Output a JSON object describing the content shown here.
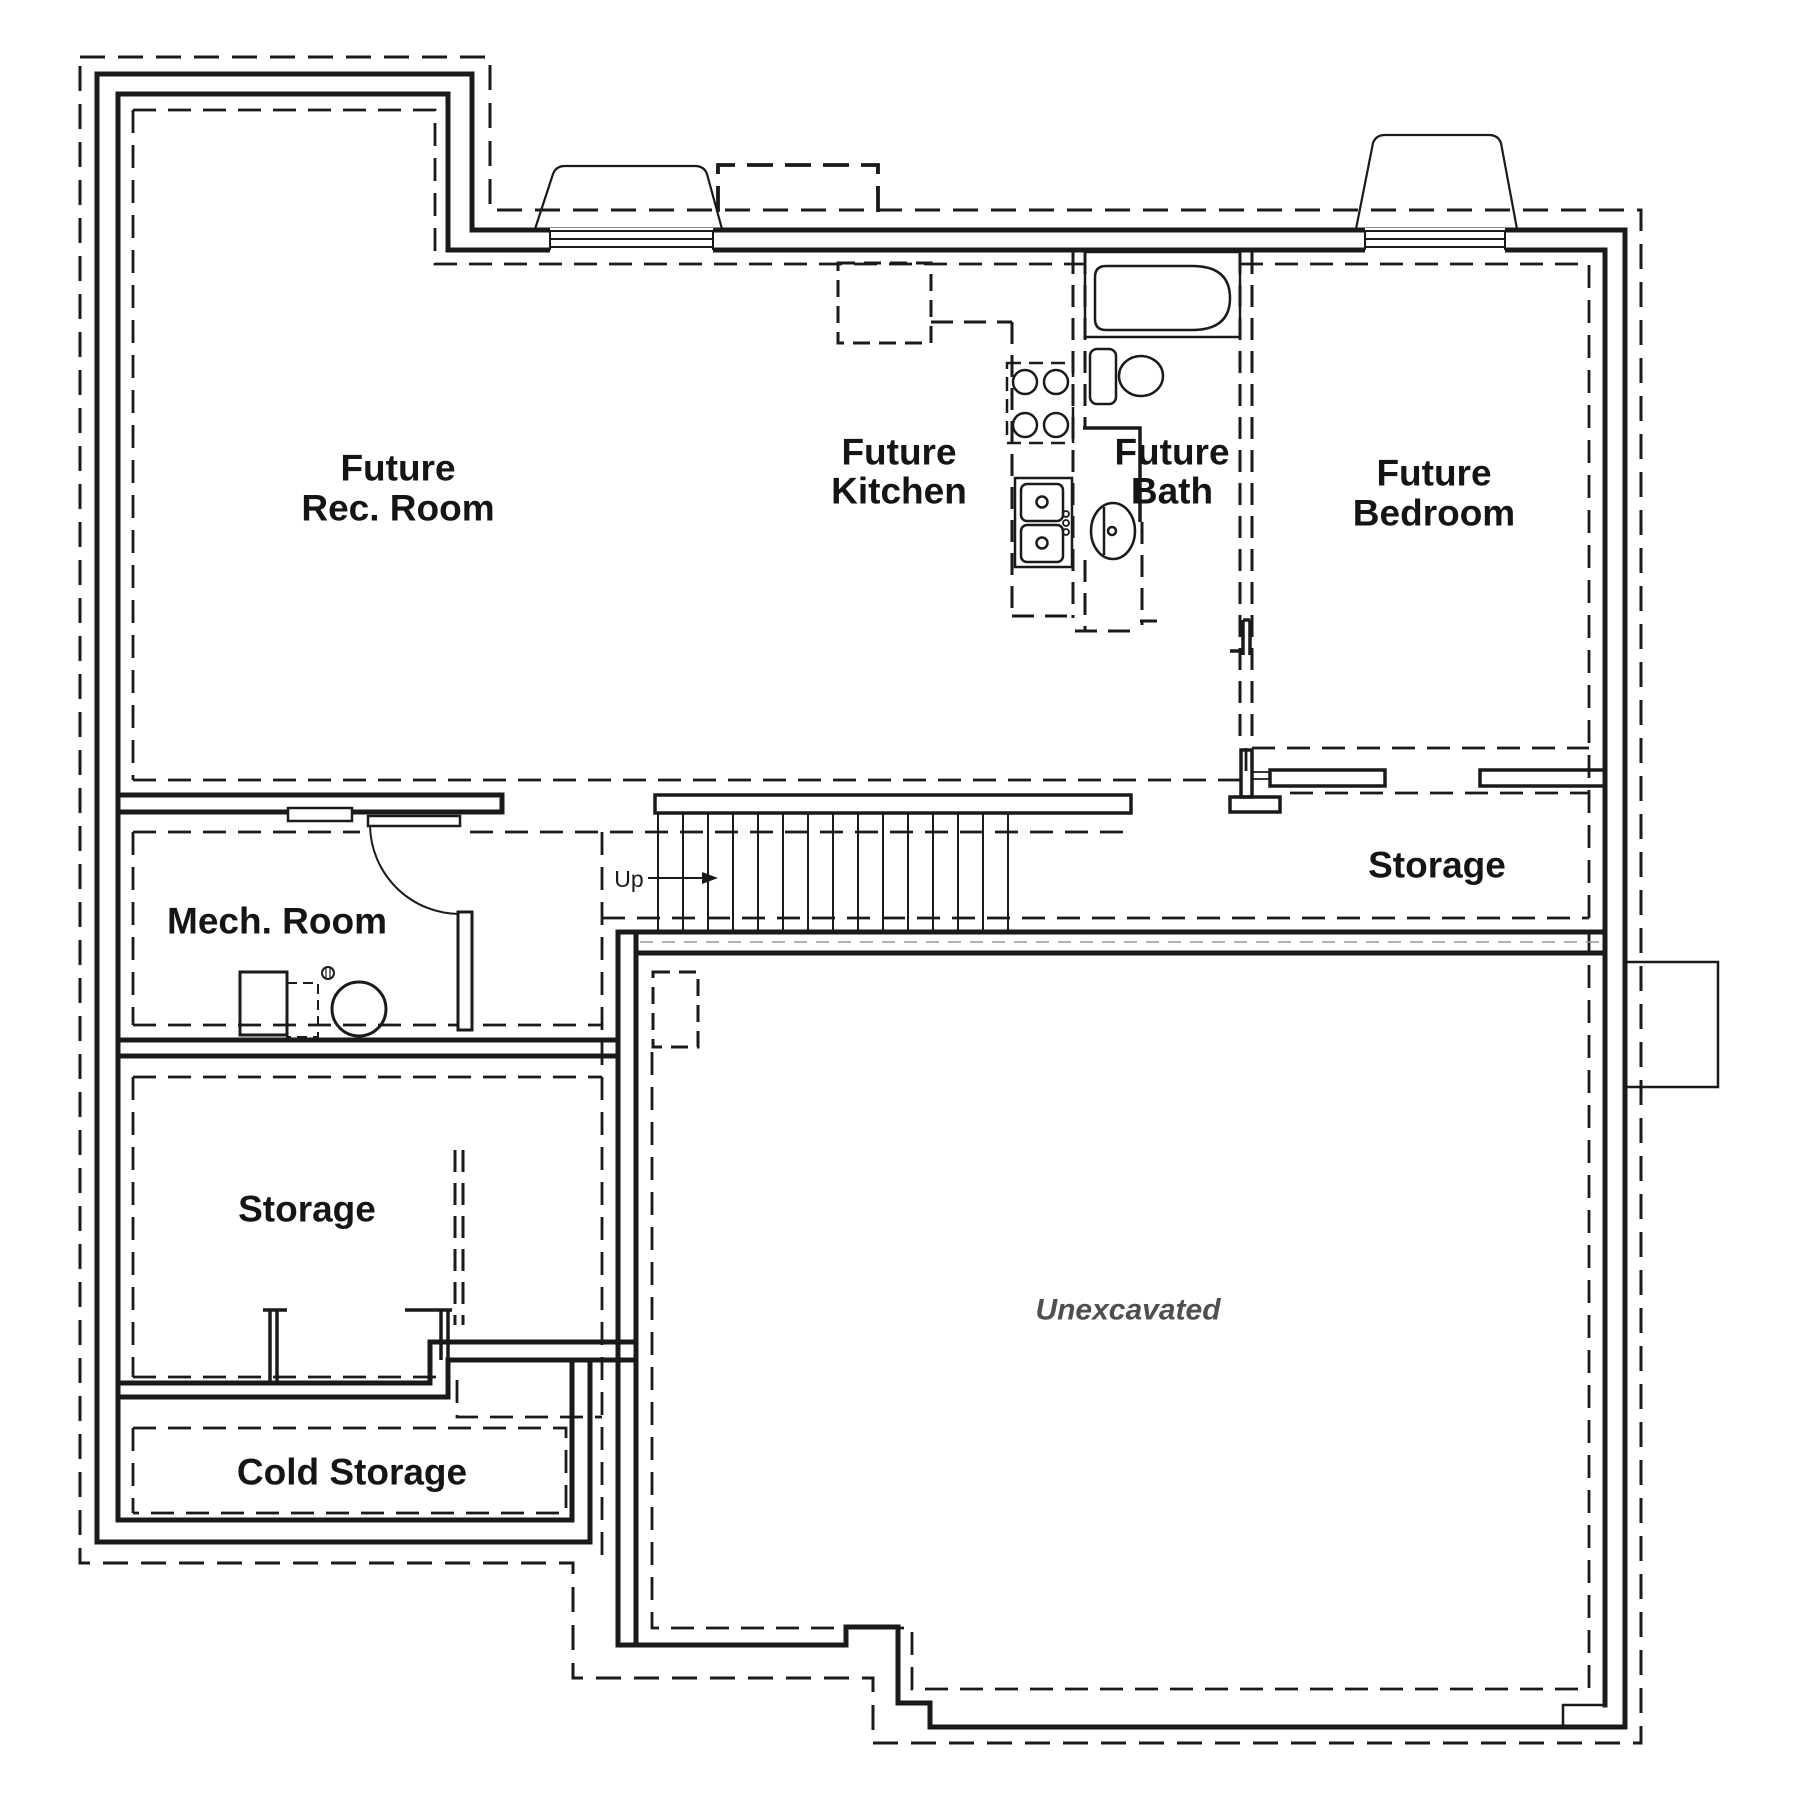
{
  "colors": {
    "line": "#1a1a1a",
    "label_text": "#151515",
    "unexcavated_text": "#4f4f4f",
    "hidden_line": "#9a9a9a",
    "background": "#ffffff"
  },
  "rooms": {
    "rec_room": {
      "line1": "Future",
      "line2": "Rec. Room"
    },
    "kitchen": {
      "line1": "Future",
      "line2": "Kitchen"
    },
    "bath": {
      "line1": "Future",
      "line2": "Bath"
    },
    "bedroom": {
      "line1": "Future",
      "line2": "Bedroom"
    },
    "storage_right": {
      "label": "Storage"
    },
    "mech_room": {
      "label": "Mech. Room"
    },
    "storage_lower": {
      "label": "Storage"
    },
    "cold_storage": {
      "label": "Cold Storage"
    },
    "unexcavated": {
      "label": "Unexcavated"
    }
  },
  "stairs": {
    "direction_label": "Up"
  },
  "fixtures": {
    "bath_icons": [
      "bathtub-icon",
      "toilet-icon",
      "pedestal-sink-icon"
    ],
    "kitchen_icons": [
      "stove-icon",
      "double-sink-icon"
    ],
    "mech_icons": [
      "furnace-icon",
      "water-heater-icon",
      "floor-drain-icon"
    ],
    "exterior_icons": [
      "window-well-icon",
      "window-icon"
    ]
  }
}
